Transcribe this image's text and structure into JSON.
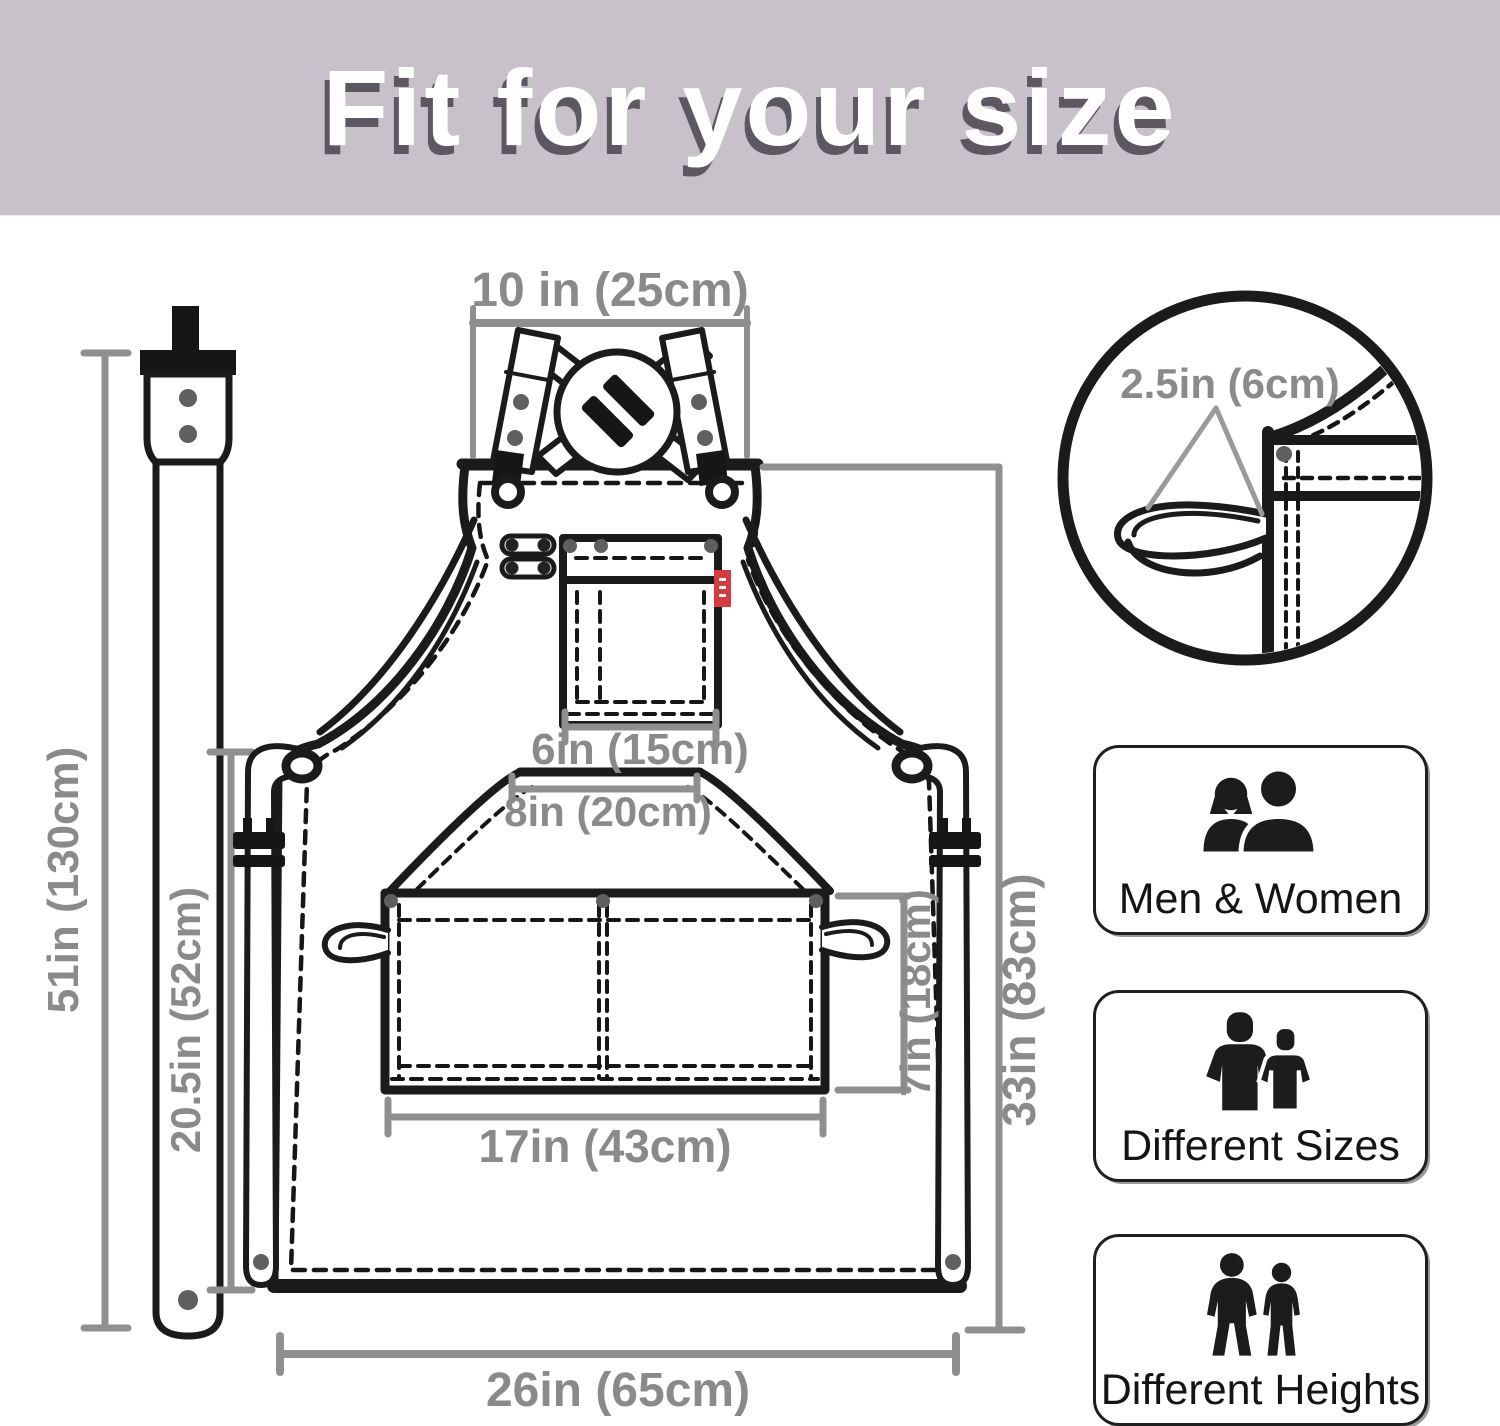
{
  "header": {
    "title": "Fit for your size",
    "bg": "#c9c1c9",
    "shadow": "#5d5761"
  },
  "diagram": {
    "labels": {
      "neck_width": "10 in (25cm)",
      "loop_detail": "2.5in (6cm)",
      "chest_pocket_width": "6in (15cm)",
      "pocket_top_width": "8in (20cm)",
      "pocket_width": "17in (43cm)",
      "pocket_height": "7in (18cm)",
      "strap_length": "51in (130cm)",
      "side_height": "20.5in (52cm)",
      "body_height": "33in (83cm)",
      "bottom_width": "26in (65cm)"
    },
    "colors": {
      "line": "#1b1b1b",
      "dimension": "#8f8f8f",
      "tag_red": "#d93a3f",
      "rivet": "#5f5f5f"
    }
  },
  "features": {
    "men_women": {
      "label": "Men & Women",
      "icon": "men-women-icon"
    },
    "sizes": {
      "label": "Different Sizes",
      "icon": "different-sizes-icon"
    },
    "heights": {
      "label": "Different Heights",
      "icon": "different-heights-icon"
    }
  }
}
